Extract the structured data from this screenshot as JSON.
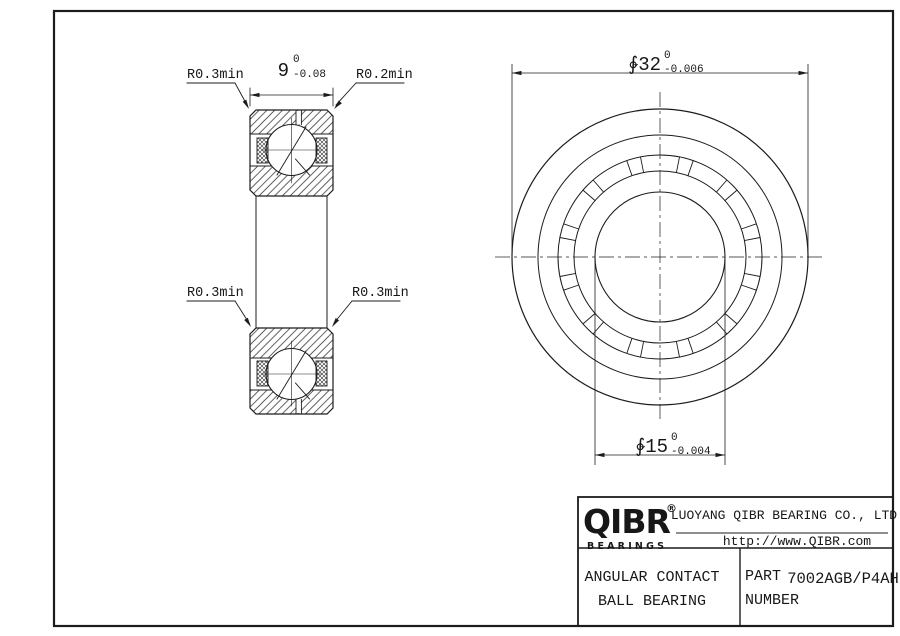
{
  "views": {
    "section": {
      "radius_labels": {
        "top_left": "R0.3min",
        "top_right": "R0.2min",
        "mid_left": "R0.3min",
        "mid_right": "R0.3min"
      },
      "width_dim": {
        "value": "9",
        "tol_upper": "0",
        "tol_lower": "-0.08"
      }
    },
    "front": {
      "outer_dim": {
        "value": "∲32",
        "tol_upper": "0",
        "tol_lower": "-0.006"
      },
      "bore_dim": {
        "value": "∲15",
        "tol_upper": "0",
        "tol_lower": "-0.004"
      }
    }
  },
  "title_block": {
    "logo": {
      "text": "QIBR",
      "registered": "®",
      "subtitle": "BEARINGS"
    },
    "company": "LUOYANG QIBR BEARING CO., LTD",
    "website": "http://www.QIBR.com",
    "product": {
      "line1": "ANGULAR CONTACT",
      "line2": "BALL BEARING"
    },
    "part": {
      "label_line1": "PART",
      "label_line2": "NUMBER",
      "number": "7002AGB/P4AH"
    }
  }
}
